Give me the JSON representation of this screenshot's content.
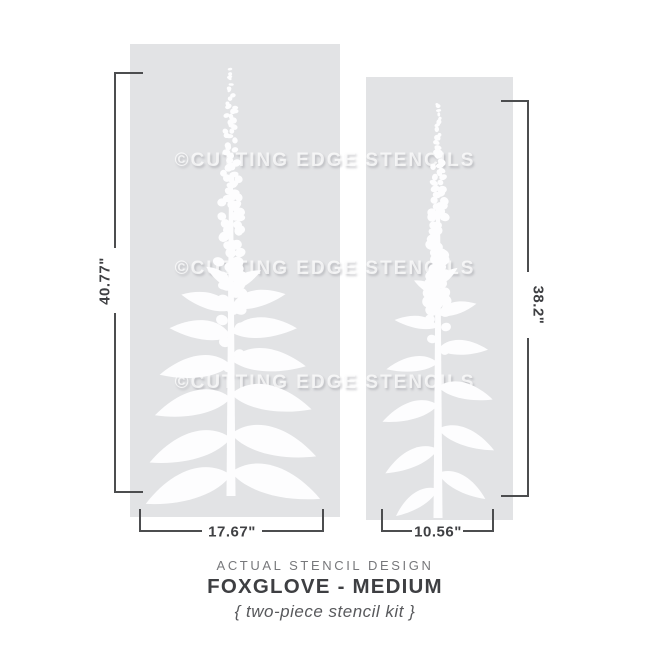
{
  "watermark": {
    "text": "©CUTTING EDGE STENCILS"
  },
  "stencil_left": {
    "height_label": "40.77\"",
    "width_label": "17.67\""
  },
  "stencil_right": {
    "height_label": "38.2\"",
    "width_label": "10.56\""
  },
  "caption": {
    "kicker": "ACTUAL STENCIL DESIGN",
    "title": "FOXGLOVE - MEDIUM",
    "subtitle": "{ two-piece stencil kit }"
  },
  "colors": {
    "background": "#ffffff",
    "panel": "#e2e3e5",
    "stencil_art": "#fdfdfe",
    "dimension_line": "#4c4d4f",
    "dimension_text": "#3f4043",
    "kicker_text": "#77787b",
    "title_text": "#3e3f42",
    "subtitle_text": "#58595c",
    "watermark_text": "#fdfdfe"
  }
}
